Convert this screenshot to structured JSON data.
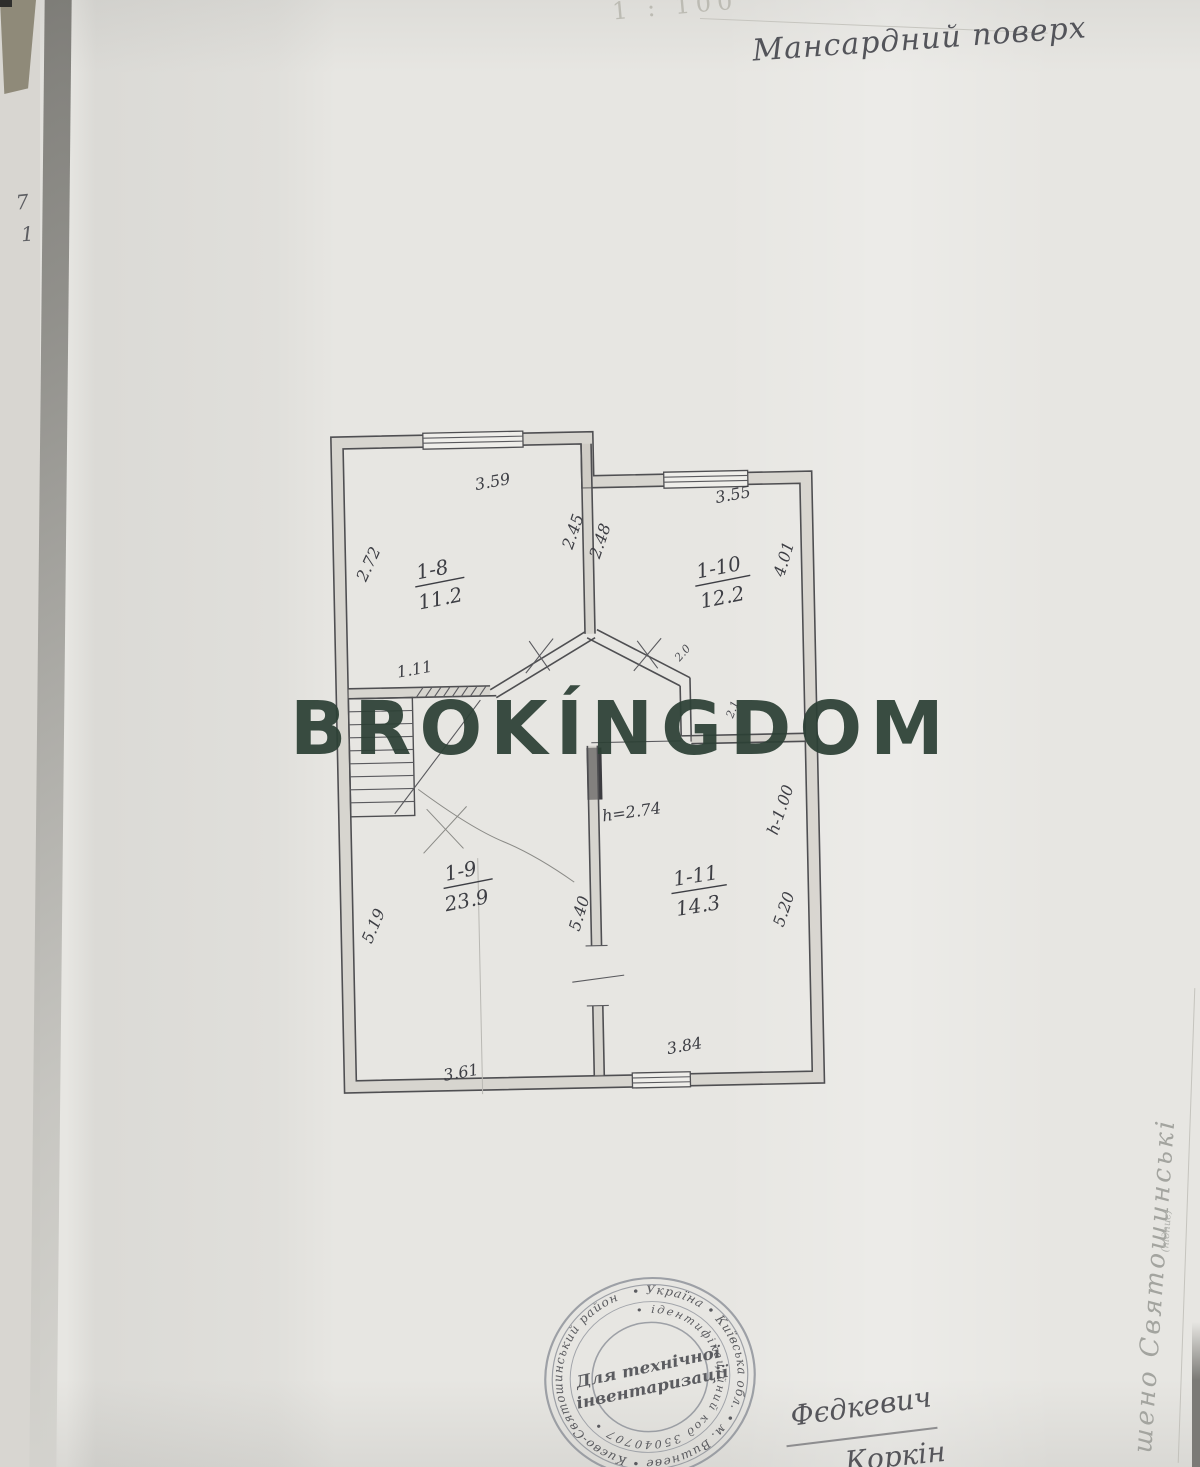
{
  "document": {
    "scale_note": "1 : 100",
    "floor_title": "Мансардний поверх",
    "edge_marks": {
      "a": "7",
      "b": "1"
    }
  },
  "watermark": {
    "text": "BROKÍNGDOM",
    "color": "#2c4035"
  },
  "floor_plan": {
    "rooms": {
      "r18": {
        "id": "1-8",
        "area": "11.2"
      },
      "r110": {
        "id": "1-10",
        "area": "12.2"
      },
      "r19": {
        "id": "1-9",
        "area": "23.9"
      },
      "r111": {
        "id": "1-11",
        "area": "14.3"
      }
    },
    "dims": {
      "top_left": "3.59",
      "top_right": "3.55",
      "left_upper": "2.72",
      "angled_left": "2.45",
      "angled_right": "2.48",
      "right_upper": "4.01",
      "stair": "1.11",
      "hall_a": "2.0",
      "hall_b": "2.1",
      "height_hall": "h=2.74",
      "height_right": "h-1.00",
      "left_lower": "5.19",
      "center": "5.40",
      "right_lower": "5.20",
      "bottom_left": "3.61",
      "bottom_right": "3.84"
    }
  },
  "stamp": {
    "ring_outer": "• Україна • Київська обл. • м. Вишневе • Києво-Святошинський район",
    "ring_inner": "• ідентифікаційний код 35040707 •",
    "center_line1": "Для технічної",
    "center_line2": "інвентаризації"
  },
  "signatures": {
    "line1": "Фєдкевич",
    "line2": "Коркін"
  },
  "margin_note": {
    "vertical_text": "шено Святошинські",
    "small_note": "(підпис)"
  }
}
